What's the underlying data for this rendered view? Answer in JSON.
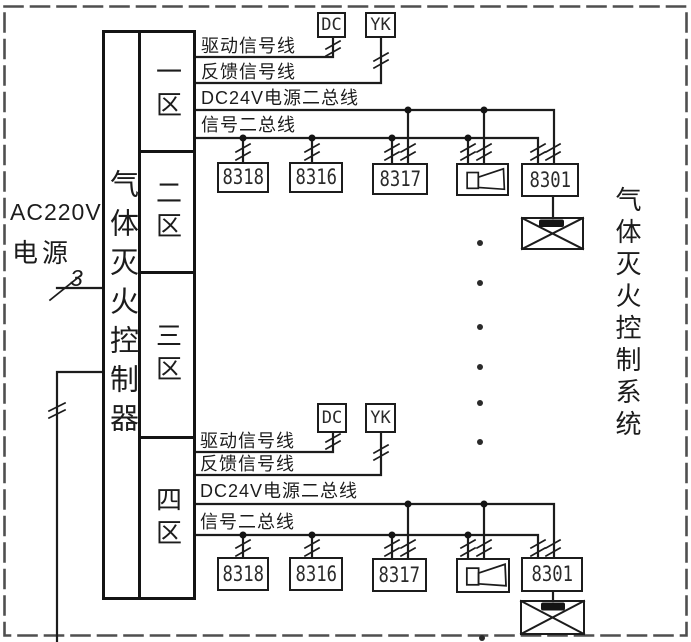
{
  "colors": {
    "ink": "#1c1c1c",
    "frame_dash": "#4f4f4f",
    "background": "#ffffff"
  },
  "power": {
    "line1": "AC220V",
    "line2": "电源",
    "wire_count": "3"
  },
  "controller": {
    "title": "气体灭火控制器",
    "zones": [
      "一区",
      "二区",
      "三区",
      "四区"
    ]
  },
  "system_caption": "气体灭火控制系统",
  "sections": [
    {
      "wire_labels": {
        "drive": "驱动信号线",
        "feedback": "反馈信号线",
        "power_bus": "DC24V电源二总线",
        "signal_bus": "信号二总线"
      },
      "dc_label": "DC",
      "yk_label": "YK",
      "devices": [
        "8318",
        "8316",
        "8317",
        "8301"
      ]
    },
    {
      "wire_labels": {
        "drive": "驱动信号线",
        "feedback": "反馈信号线",
        "power_bus": "DC24V电源二总线",
        "signal_bus": "信号二总线"
      },
      "dc_label": "DC",
      "yk_label": "YK",
      "devices": [
        "8318",
        "8316",
        "8317",
        "8301"
      ]
    }
  ]
}
